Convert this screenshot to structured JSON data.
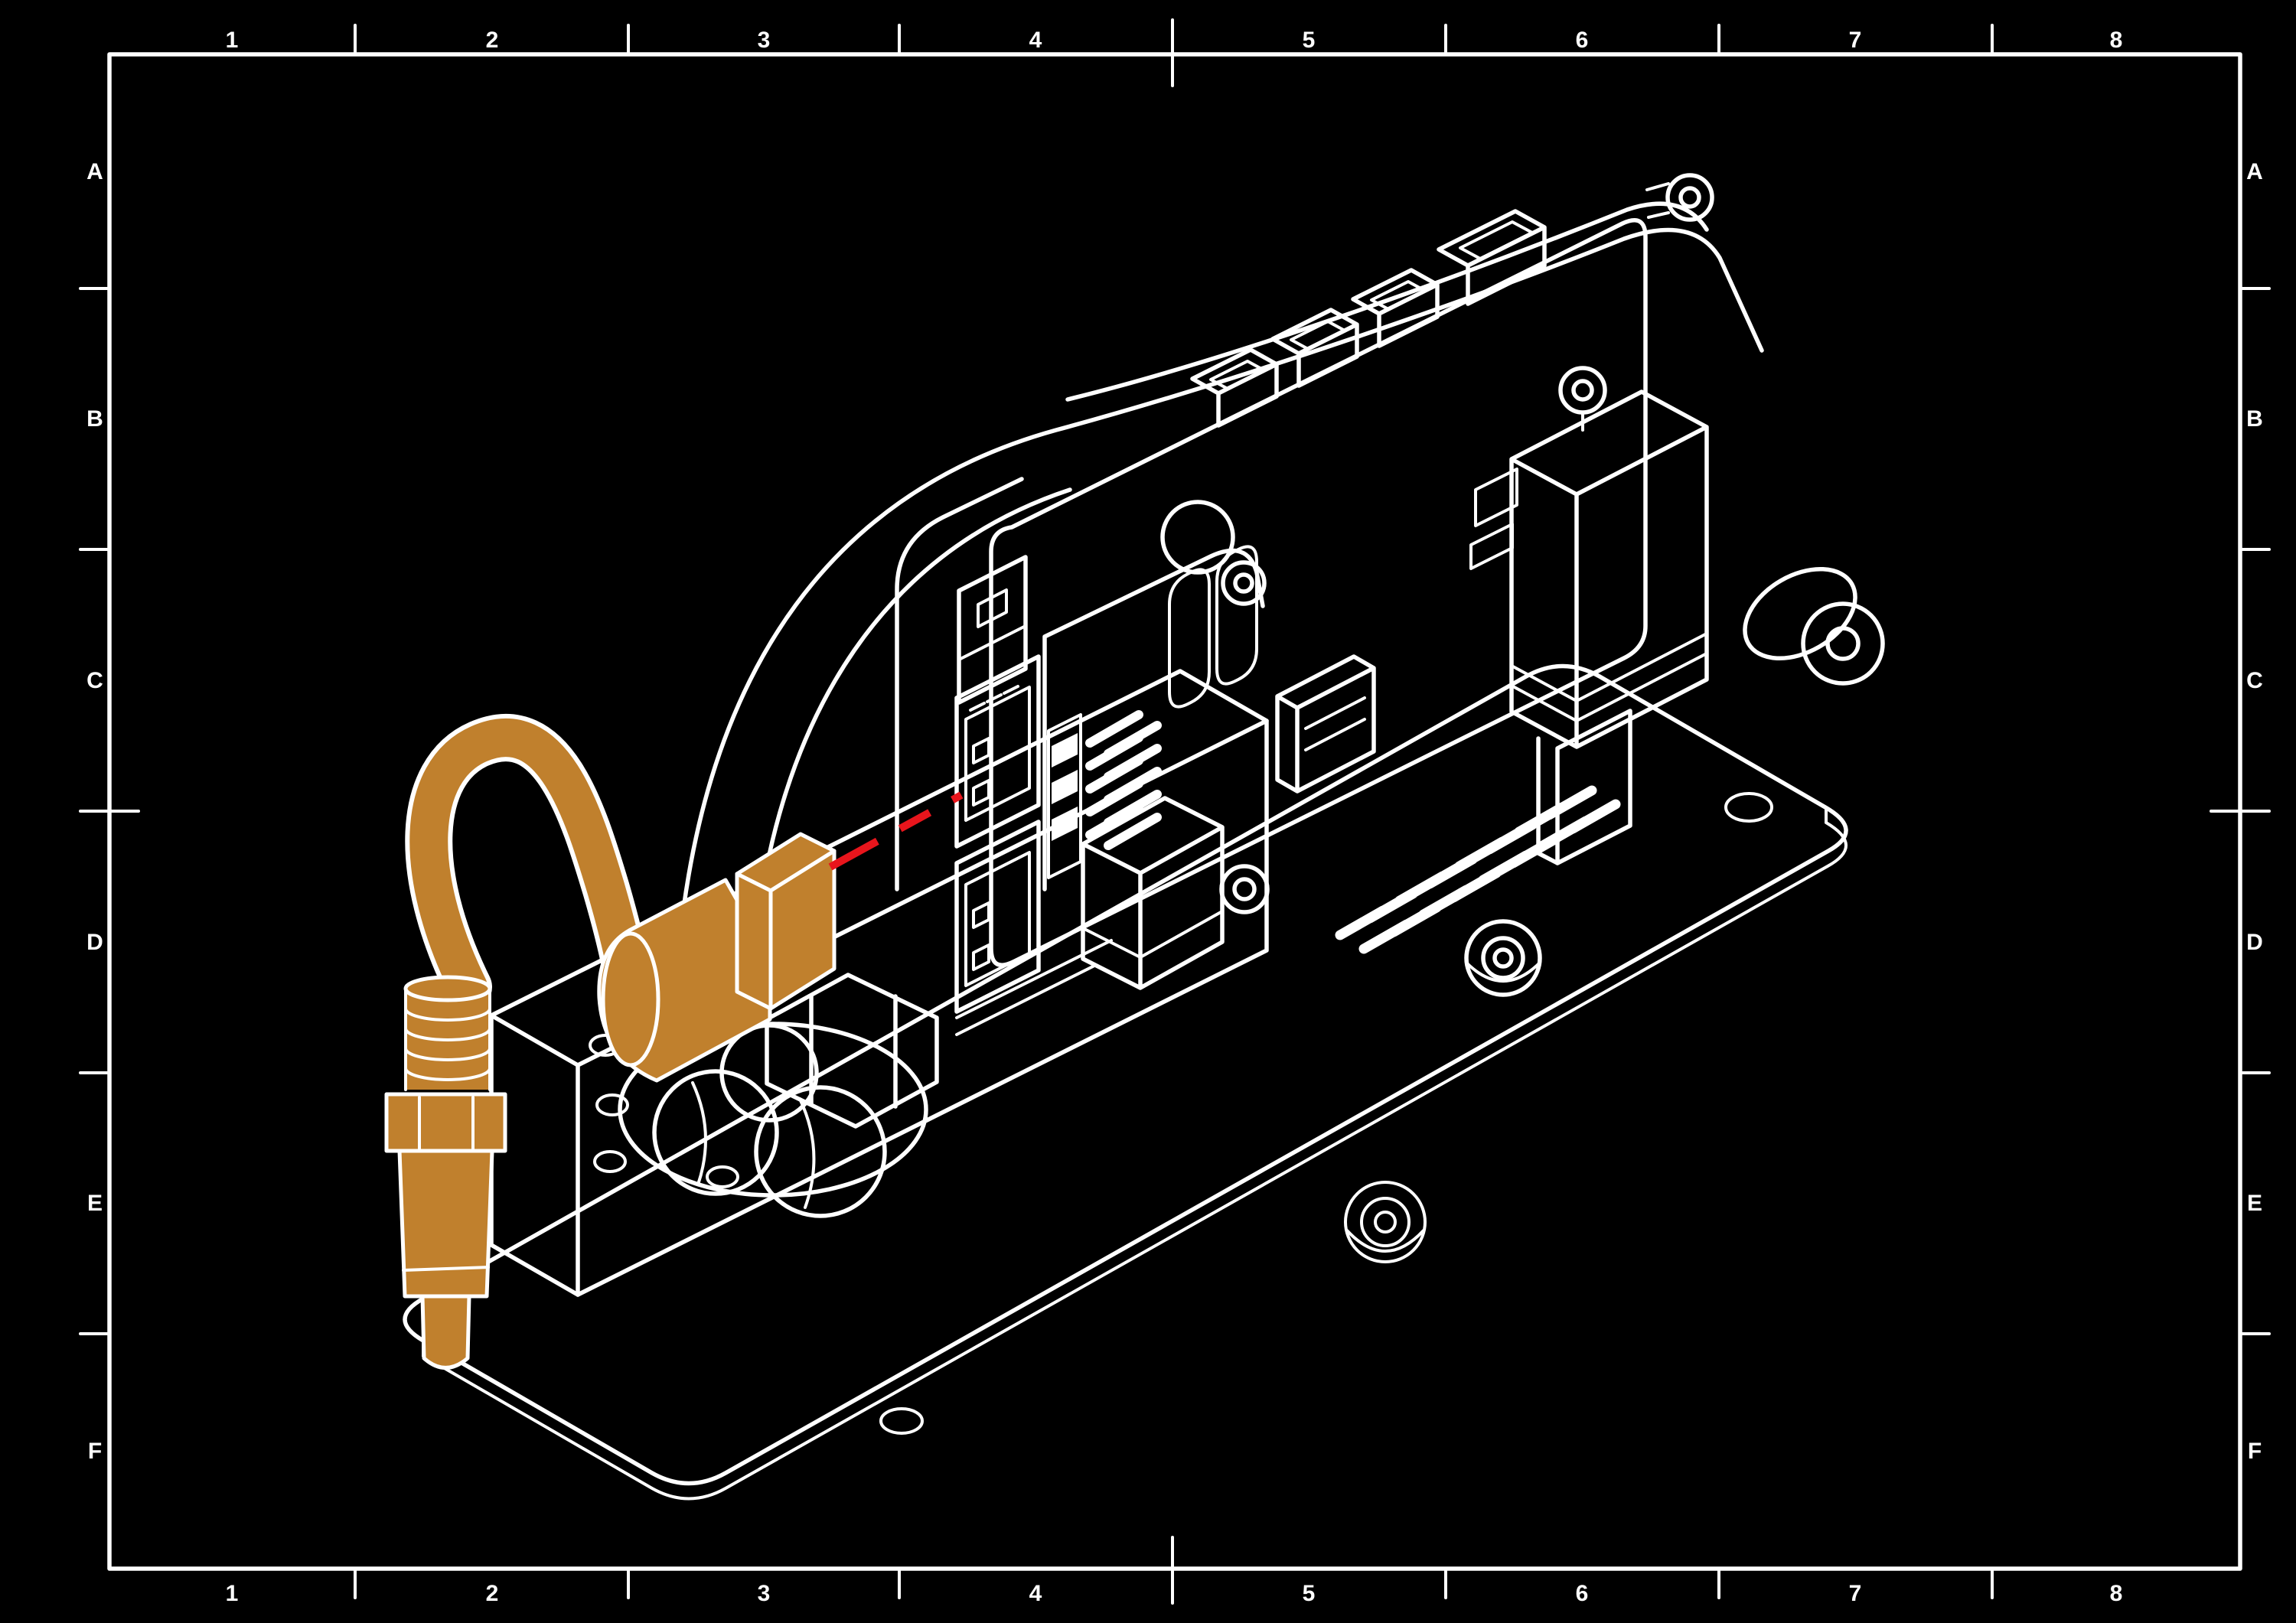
{
  "theme": {
    "bg": "#000000",
    "line": "#ffffff",
    "hl": "#c0802d",
    "guide": "#e8151c"
  },
  "frame": {
    "columns": [
      "1",
      "2",
      "3",
      "4",
      "5",
      "6",
      "7",
      "8"
    ],
    "rows": [
      "A",
      "B",
      "C",
      "D",
      "E",
      "F"
    ]
  },
  "figure": {
    "type": "isometric-assembly-step-drawing",
    "highlighted_part": "power-connector-with-cable",
    "guide_meaning": "insertion-direction",
    "parts": [
      "baseplate-with-mounting-holes",
      "arched-housing-with-port-cutouts",
      "ethernet-port-window",
      "module-cage-upper",
      "module-cage-lower",
      "circuit-board",
      "board-edge-connectors",
      "chip-component",
      "pin-header-vertical",
      "gpio-pin-header",
      "standoff-washers",
      "relay-box",
      "servo-motor",
      "roller-wheel",
      "ball-caster",
      "xt60-connector-orange",
      "cable-loop-orange",
      "dc-jack-orange",
      "insertion-guide-dashed-line"
    ]
  }
}
